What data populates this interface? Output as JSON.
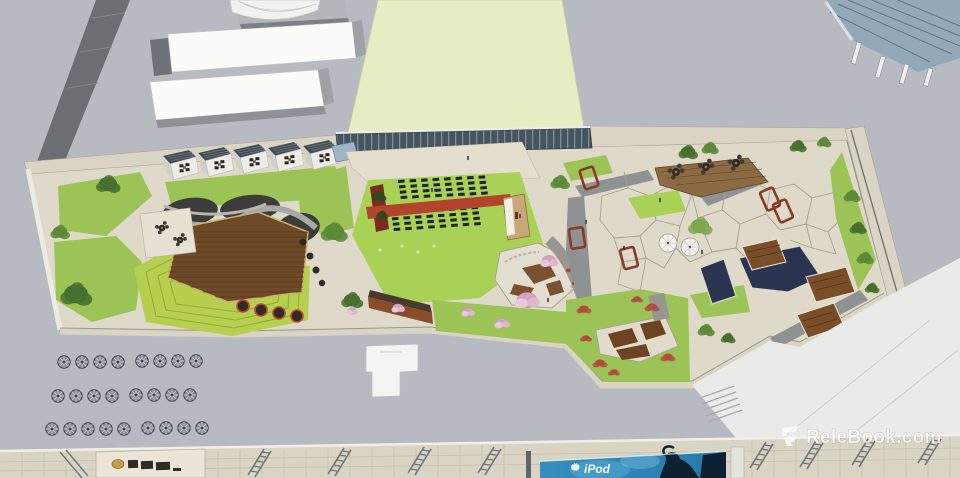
{
  "watermark": {
    "text": "ReleBook.com"
  },
  "billboard": {
    "brand": "iPod"
  },
  "icons": {
    "watermark_logo": "relebook-monogram",
    "apple_logo": "apple-silhouette",
    "parasol": "white-umbrella",
    "cafe_table": "round-table-with-chairs"
  },
  "palette": {
    "roof_gray": "#b7bbc1",
    "roof_white": "#eaeae8",
    "lawn_pale": "#e7edc2",
    "lawn": "#9cc356",
    "lawn_bright": "#a9d156",
    "terrace_lawn": "#b7cf4f",
    "paving": "#ded9c9",
    "paving_light": "#e6e1d2",
    "granite_gray": "#8f9292",
    "planting_dark": "#3c3c3a",
    "deck_brown": "#6f4a29",
    "deck_light": "#8b6a44",
    "carpet_red": "#b2432c",
    "corten_rust": "#8a4c28",
    "water_navy": "#2b3450",
    "tree_dark": "#47702e",
    "tree_mid": "#5c8a38",
    "tree_light": "#7fa84e",
    "blossom_pink": "#d2a5bf",
    "shrub_red": "#b24a3e",
    "stone_wall": "#d9d4c3",
    "glass_blue": "#93a9b9",
    "billboard_blue": "#2f86b5",
    "silhouette_navy": "#0d2130"
  }
}
